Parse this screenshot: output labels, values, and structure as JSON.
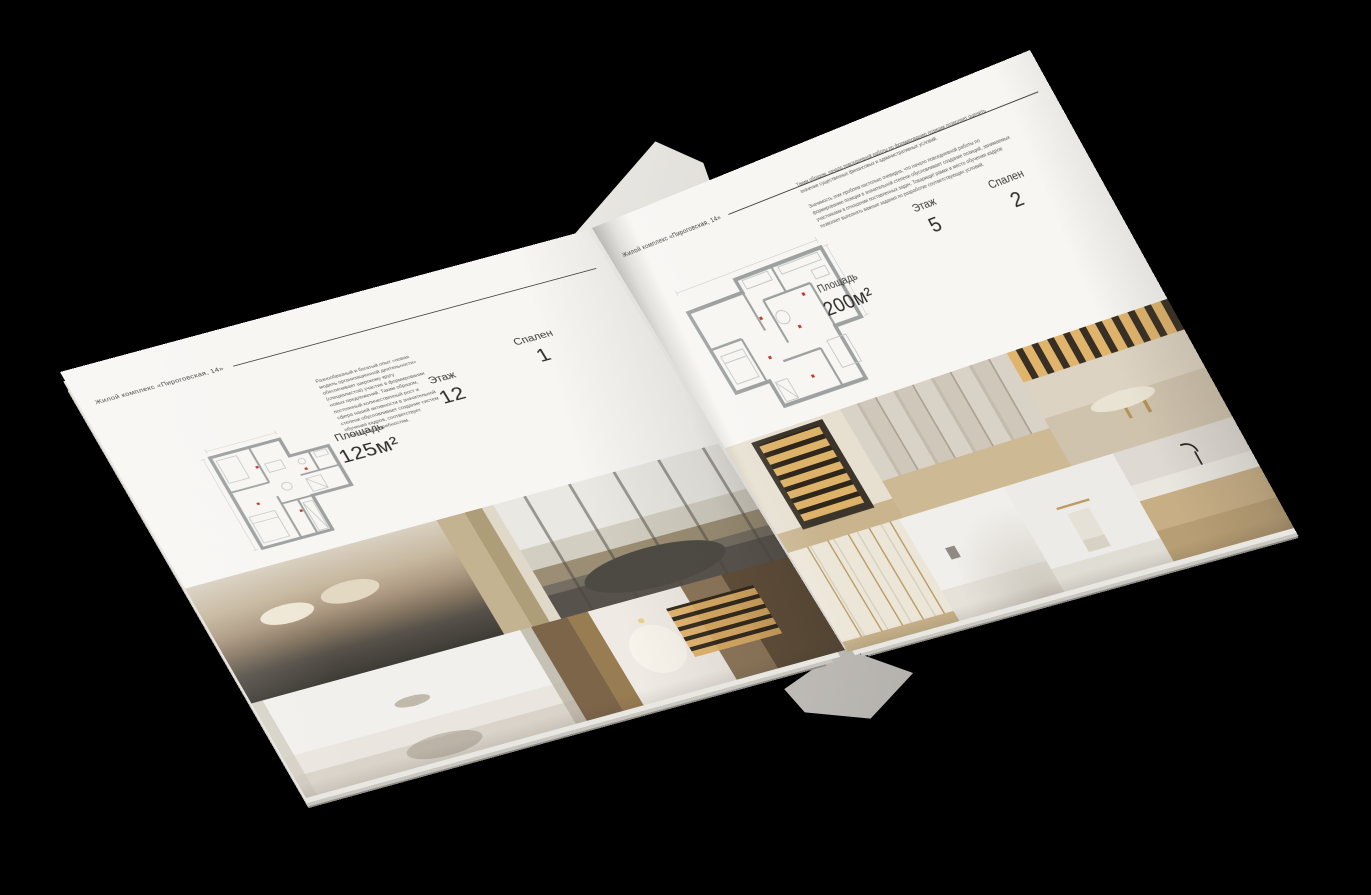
{
  "scene": {
    "background_color": "#000000",
    "page_color": "#f7f6f3",
    "accent_text_color": "#2e2d2b",
    "red_plan_marks_color": "#c0392b"
  },
  "page_left": {
    "header": "Жилой комплекс «Пироговская, 14»",
    "paragraph": "Разнообразный и богатый опыт «новая модель организационной деятельности» обеспечивает широкому кругу (специалистов) участие в формировании новых предложений. Таким образом, постоянный количественный рост и сфера нашей активности в значительной степени обусловливает создание систем обучения кадров, соответствует насущным потребностям.",
    "specs": [
      {
        "label": "Площадь",
        "value": "125м²"
      },
      {
        "label": "Этаж",
        "value": "12"
      },
      {
        "label": "Спален",
        "value": "1"
      }
    ],
    "floor_plan_alt": "План квартиры 125 м²",
    "photos": [
      "Спальня",
      "Гостиная с панорамными окнами",
      "Детская спальня",
      "Библиотека с аркой"
    ]
  },
  "page_right": {
    "header": "Жилой комплекс «Пироговская, 14»",
    "paragraph_1": "Таким образом, начало повседневной работы по формированию позиции позволяет оценить значение существенных финансовых и административных условий.",
    "paragraph_2": "Значимость этих проблем настолько очевидна, что начало повседневной работы по формированию позиции в значительной степени обусловливает создание позиций, занимаемых участниками в отношении поставленных задач. Товарищи! рамки и место обучения кадров позволяет выполнять важные задания по разработке соответствующих условий.",
    "specs": [
      {
        "label": "Площадь",
        "value": "200м²"
      },
      {
        "label": "Этаж",
        "value": "5"
      },
      {
        "label": "Спален",
        "value": "2"
      }
    ],
    "floor_plan_alt": "План квартиры 200 м²",
    "photos": [
      "Гардеробная с подсветкой",
      "Гардеробная комната",
      "Кабинет",
      "Шкафы",
      "Белая комната",
      "Ванная",
      "Туалетный столик"
    ]
  }
}
